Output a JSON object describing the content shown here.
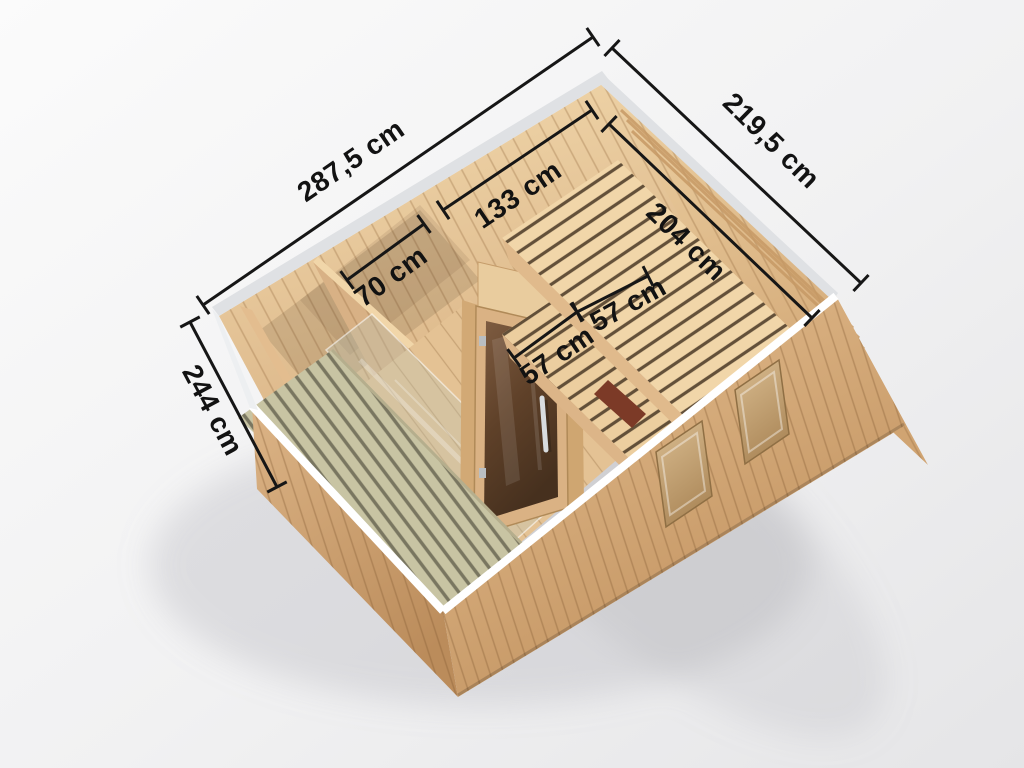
{
  "meta": {
    "canvas": {
      "width": 1024,
      "height": 768
    },
    "style": {
      "background_top": "#fafafa",
      "background_bottom": "#e6e6e8",
      "dimension_line_color": "#161616",
      "dimension_label_color": "#121212",
      "wood_light": "#f1d6a9",
      "wood_mid": "#d9b183",
      "wood_dark": "#c2925f",
      "roof_trim": "#dfe1e4",
      "cut_edge_trim": "#ffffff",
      "door_glass": "#5f4129",
      "terrace_floor": "#c8c4a3"
    }
  },
  "diagram": {
    "type": "3d-cutaway-dimension-render",
    "subject": "Wooden sauna cabin cutaway render with glass door, two-tier benches, storage niche and terrace",
    "unit": "cm",
    "overall": {
      "width": "287,5 cm",
      "depth": "219,5 cm",
      "height": "244 cm"
    },
    "interior": {
      "room_length": "204 cm",
      "room_width": "133 cm",
      "niche_width": "70 cm",
      "bench_depth_upper": "57 cm",
      "bench_depth_lower": "57 cm"
    }
  },
  "dimensions": [
    {
      "name": "overall-width",
      "label": "287,5 cm",
      "value_cm": 287.5,
      "x1": 203,
      "y1": 305,
      "x2": 593,
      "y2": 37,
      "lx": 352,
      "ly": 162,
      "rot": -34.5
    },
    {
      "name": "overall-depth",
      "label": "219,5 cm",
      "value_cm": 219.5,
      "x1": 612,
      "y1": 48,
      "x2": 861,
      "y2": 283,
      "lx": 770,
      "ly": 142,
      "rot": 44.5
    },
    {
      "name": "overall-height",
      "label": "244 cm",
      "value_cm": 244,
      "x1": 190,
      "y1": 322,
      "x2": 277,
      "y2": 487,
      "lx": 211,
      "ly": 411,
      "rot": 62
    },
    {
      "name": "room-width",
      "label": "133 cm",
      "value_cm": 133,
      "x1": 443,
      "y1": 210,
      "x2": 592,
      "y2": 110,
      "lx": 519,
      "ly": 196,
      "rot": -34
    },
    {
      "name": "room-length",
      "label": "204 cm",
      "value_cm": 204,
      "x1": 609,
      "y1": 124,
      "x2": 812,
      "y2": 318,
      "lx": 685,
      "ly": 243,
      "rot": 44
    },
    {
      "name": "niche-width",
      "label": "70 cm",
      "value_cm": 70,
      "x1": 347,
      "y1": 280,
      "x2": 424,
      "y2": 224,
      "lx": 392,
      "ly": 278,
      "rot": -36
    },
    {
      "name": "bench-depth-lower",
      "label": "57 cm",
      "value_cm": 57,
      "x1": 514,
      "y1": 358,
      "x2": 577,
      "y2": 312,
      "lx": 558,
      "ly": 357,
      "rot": -34
    },
    {
      "name": "bench-depth-upper",
      "label": "57 cm",
      "value_cm": 57,
      "x1": 577,
      "y1": 312,
      "x2": 648,
      "y2": 276,
      "lx": 629,
      "ly": 306,
      "rot": -29
    }
  ]
}
